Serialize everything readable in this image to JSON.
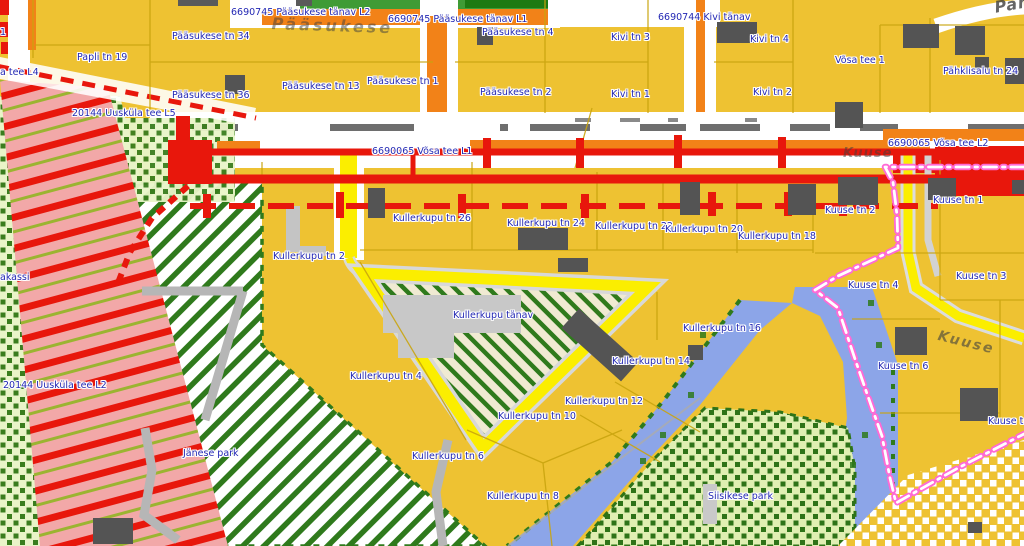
{
  "map": {
    "title": "Cadastral zoning map view",
    "palette": {
      "parcel_gold": "#eec232",
      "road_white": "#ffffff",
      "road_orange": "#f28218",
      "closure_red": "#e8170c",
      "corridor_pink": "#f2a8a8",
      "park_stripe_green": "#2f7a1c",
      "meadow_light_green": "#e9f4c8",
      "zone_blue": "#8ca5e8",
      "street_yellow": "#fbee00",
      "boundary_pink": "#ff6ad5",
      "building_gray": "#545454",
      "label_blue": "#2328b4",
      "parcel_line_olive": "#c9a40e"
    },
    "labels": [
      {
        "t": "6690745 Pääsukese tänav L2",
        "x": 231,
        "y": 7
      },
      {
        "t": "6690745 Pääsukese tänav L1",
        "x": 388,
        "y": 14
      },
      {
        "t": "6690744 Kivi tänav",
        "x": 658,
        "y": 12
      },
      {
        "t": "Pääsukese tn 34",
        "x": 172,
        "y": 31
      },
      {
        "t": "Papli tn 19",
        "x": 77,
        "y": 52
      },
      {
        "t": "a tee L4",
        "x": 0,
        "y": 67
      },
      {
        "t": "Pääsukese tn 36",
        "x": 172,
        "y": 90
      },
      {
        "t": "Pääsukese tn 13",
        "x": 282,
        "y": 81
      },
      {
        "t": "Pääsukese tn 1",
        "x": 367,
        "y": 76
      },
      {
        "t": "Pääsukese tn 4",
        "x": 482,
        "y": 27
      },
      {
        "t": "Pääsukese tn 2",
        "x": 480,
        "y": 87
      },
      {
        "t": "Kivi tn 3",
        "x": 611,
        "y": 32
      },
      {
        "t": "Kivi tn 1",
        "x": 611,
        "y": 89
      },
      {
        "t": "Kivi tn 4",
        "x": 750,
        "y": 34
      },
      {
        "t": "Kivi tn 2",
        "x": 753,
        "y": 87
      },
      {
        "t": "Võsa tee 1",
        "x": 835,
        "y": 55
      },
      {
        "t": "Pähklisalu tn 24",
        "x": 943,
        "y": 66
      },
      {
        "t": "20144 Uusküla tee L5",
        "x": 72,
        "y": 108
      },
      {
        "t": "6690065 Võsa tee L1",
        "x": 372,
        "y": 146
      },
      {
        "t": "6690065 Võsa tee L2",
        "x": 888,
        "y": 138
      },
      {
        "t": "Kullerkupu tn 26",
        "x": 393,
        "y": 213
      },
      {
        "t": "Kullerkupu tn 24",
        "x": 507,
        "y": 218
      },
      {
        "t": "Kullerkupu tn 22",
        "x": 595,
        "y": 221
      },
      {
        "t": "Kullerkupu tn 20",
        "x": 665,
        "y": 224
      },
      {
        "t": "Kullerkupu tn 18",
        "x": 738,
        "y": 231
      },
      {
        "t": "Kuuse tn 2",
        "x": 825,
        "y": 205
      },
      {
        "t": "Kuuse tn 1",
        "x": 933,
        "y": 195
      },
      {
        "t": "Kullerkupu tn 2",
        "x": 273,
        "y": 251
      },
      {
        "t": "Kuuse tn 3",
        "x": 956,
        "y": 271
      },
      {
        "t": "Kuuse tn 4",
        "x": 848,
        "y": 280
      },
      {
        "t": "Kullerkupu tänav",
        "x": 453,
        "y": 310
      },
      {
        "t": "Kullerkupu tn 16",
        "x": 683,
        "y": 323
      },
      {
        "t": "Kullerkupu tn 14",
        "x": 612,
        "y": 356
      },
      {
        "t": "Kuuse tn 6",
        "x": 878,
        "y": 361
      },
      {
        "t": "Kullerkupu tn 4",
        "x": 350,
        "y": 371
      },
      {
        "t": "20144 Uusküla tee L2",
        "x": 3,
        "y": 380
      },
      {
        "t": "Kullerkupu tn 12",
        "x": 565,
        "y": 396
      },
      {
        "t": "Kullerkupu tn 10",
        "x": 498,
        "y": 411
      },
      {
        "t": "Kuuse tn",
        "x": 988,
        "y": 416
      },
      {
        "t": "Jänese park",
        "x": 183,
        "y": 448
      },
      {
        "t": "Kullerkupu tn 6",
        "x": 412,
        "y": 451
      },
      {
        "t": "Kullerkupu tn 8",
        "x": 487,
        "y": 491
      },
      {
        "t": "Siisikese park",
        "x": 708,
        "y": 491
      },
      {
        "t": "akassi",
        "x": 0,
        "y": 272
      },
      {
        "t": "1",
        "x": 0,
        "y": 27
      }
    ],
    "faded_streets": [
      {
        "t": "Pääsukese",
        "x": 272,
        "y": 14,
        "size": 16,
        "rot": 2,
        "ls": 3,
        "op": 0.5
      },
      {
        "t": "Päh",
        "x": 993,
        "y": -2,
        "size": 16,
        "rot": -10,
        "ls": 1,
        "op": 0.8
      },
      {
        "t": "Kuuse",
        "x": 843,
        "y": 146,
        "size": 13,
        "rot": 0,
        "ls": 1,
        "op": 0.5
      },
      {
        "t": "Kuuse",
        "x": 940,
        "y": 328,
        "size": 14,
        "rot": 14,
        "ls": 2,
        "op": 0.6
      }
    ],
    "buildings": [
      [
        225,
        75,
        20,
        19,
        0
      ],
      [
        477,
        27,
        16,
        18,
        0
      ],
      [
        717,
        22,
        40,
        21,
        0
      ],
      [
        903,
        24,
        36,
        24,
        0
      ],
      [
        955,
        26,
        30,
        29,
        0
      ],
      [
        975,
        57,
        14,
        13,
        0
      ],
      [
        1005,
        58,
        19,
        26,
        0
      ],
      [
        835,
        102,
        28,
        26,
        0
      ],
      [
        368,
        188,
        17,
        30,
        0
      ],
      [
        518,
        228,
        50,
        22,
        0
      ],
      [
        558,
        258,
        30,
        14,
        0
      ],
      [
        680,
        182,
        20,
        33,
        0
      ],
      [
        788,
        184,
        28,
        31,
        0
      ],
      [
        838,
        177,
        40,
        28,
        0
      ],
      [
        928,
        178,
        28,
        22,
        0
      ],
      [
        1012,
        180,
        12,
        14,
        0
      ],
      [
        560,
        332,
        80,
        26,
        42
      ],
      [
        688,
        345,
        15,
        15,
        0
      ],
      [
        895,
        327,
        32,
        28,
        0
      ],
      [
        960,
        388,
        38,
        33,
        0
      ],
      [
        93,
        518,
        40,
        26,
        0
      ],
      [
        968,
        522,
        14,
        11,
        0
      ]
    ],
    "road_marks": {
      "corridor": [
        [
          192,
          46
        ],
        [
          330,
          84
        ],
        [
          500,
          8
        ],
        [
          530,
          60
        ],
        [
          640,
          46
        ],
        [
          700,
          60
        ],
        [
          790,
          40
        ],
        [
          860,
          38
        ],
        [
          968,
          56
        ]
      ],
      "top": [
        [
          178,
          40
        ],
        [
          296,
          16
        ]
      ],
      "small": [
        [
          575,
          16
        ],
        [
          620,
          20
        ],
        [
          668,
          10
        ],
        [
          745,
          12
        ]
      ]
    }
  }
}
